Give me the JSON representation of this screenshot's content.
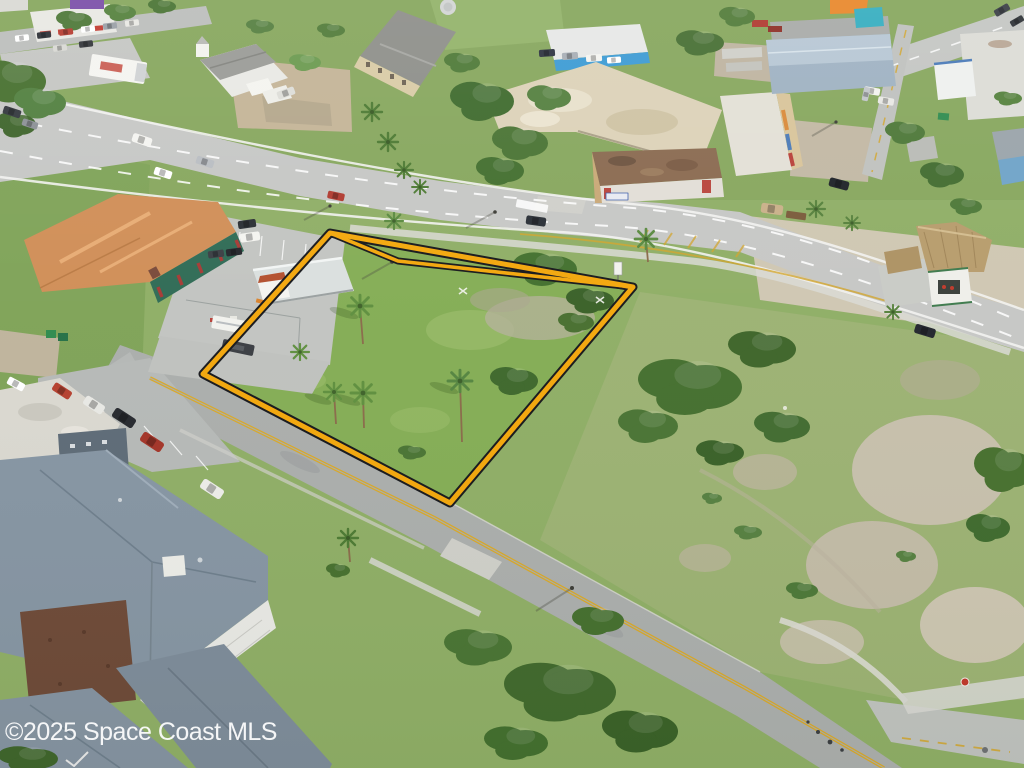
{
  "watermark": {
    "text": "©2025 Space Coast MLS",
    "color": "#ffffff"
  },
  "lot_outline": {
    "stroke_color": "#F3A70C",
    "casing_color": "#17181C"
  },
  "scene": {
    "description": "Aerial drone photo of a vacant corner lot outlined in yellow, bordered by a multi-lane highway above and a two-lane street below, surrounded by commercial buildings, palm trees, oak trees and grass fields."
  }
}
